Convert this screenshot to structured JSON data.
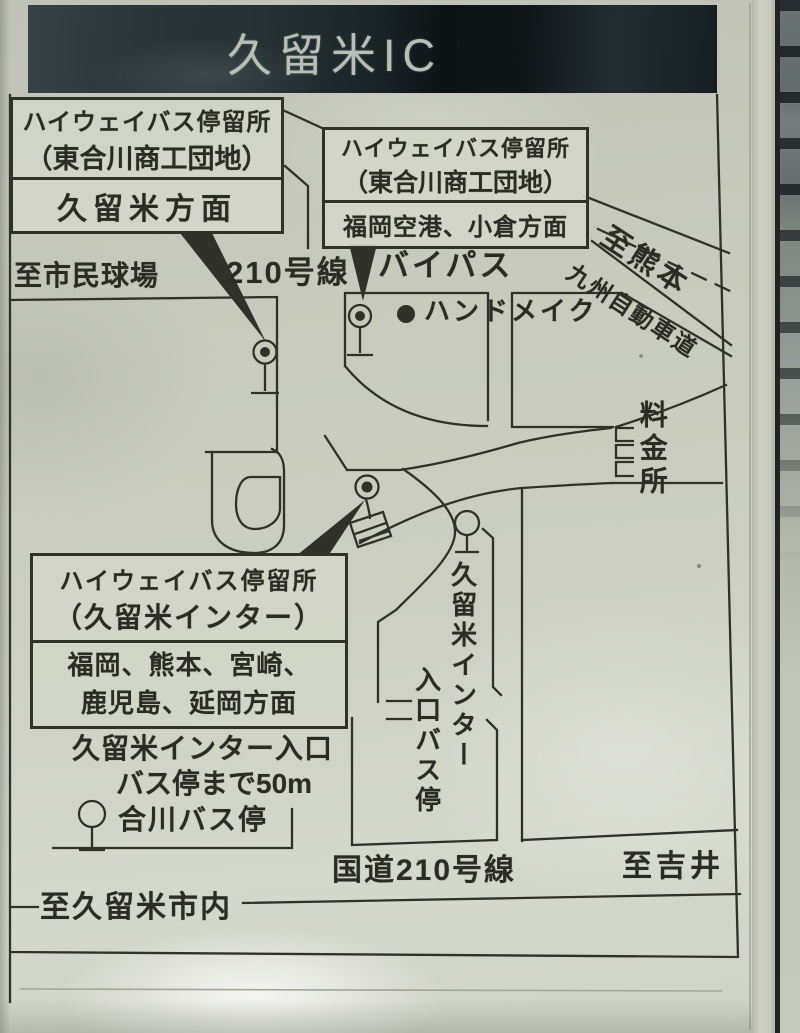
{
  "sign": {
    "title": "久留米IC",
    "boxes": {
      "box1": {
        "line1": "ハイウェイバス停留所",
        "line2": "（東合川商工団地）",
        "destination": "久留米方面"
      },
      "box2": {
        "line1": "ハイウェイバス停留所",
        "line2": "（東合川商工団地）",
        "destination": "福岡空港、小倉方面"
      },
      "box3": {
        "line1": "ハイウェイバス停留所",
        "line2": "（久留米インター）",
        "destination_line1": "福岡、熊本、宮崎、",
        "destination_line2": "鹿児島、延岡方面"
      }
    },
    "labels": {
      "to_stadium": "至市民球場",
      "route_210": "210号線",
      "bypass": "バイパス",
      "to_kumamoto": "至熊本",
      "kyushu_expressway": "九州自動車道",
      "handmade_poi": "ハンドメイク",
      "toll_gate": "料金所",
      "entrance_note_line1": "久留米インター入口",
      "entrance_note_line2": "バス停まで50m",
      "aikawa_bus_stop": "合川バス停",
      "entrance_stop_column1": "久留米インター",
      "entrance_stop_column2": "入口バス停",
      "national_route_210": "国道210号線",
      "to_yoshii": "至吉井",
      "to_kurume_city": "至久留米市内"
    },
    "symbols": {
      "bus_stop": "circle-on-pole bus stop marker",
      "poi_dot": "filled black dot",
      "toll_booth": "three toll booth brackets",
      "callout_pointer": "black triangle pointer"
    },
    "colors": {
      "paper": "#c9ccbe",
      "line": "#30322a",
      "title_bar": "#1d272a",
      "title_text": "#b7bfb7"
    }
  }
}
